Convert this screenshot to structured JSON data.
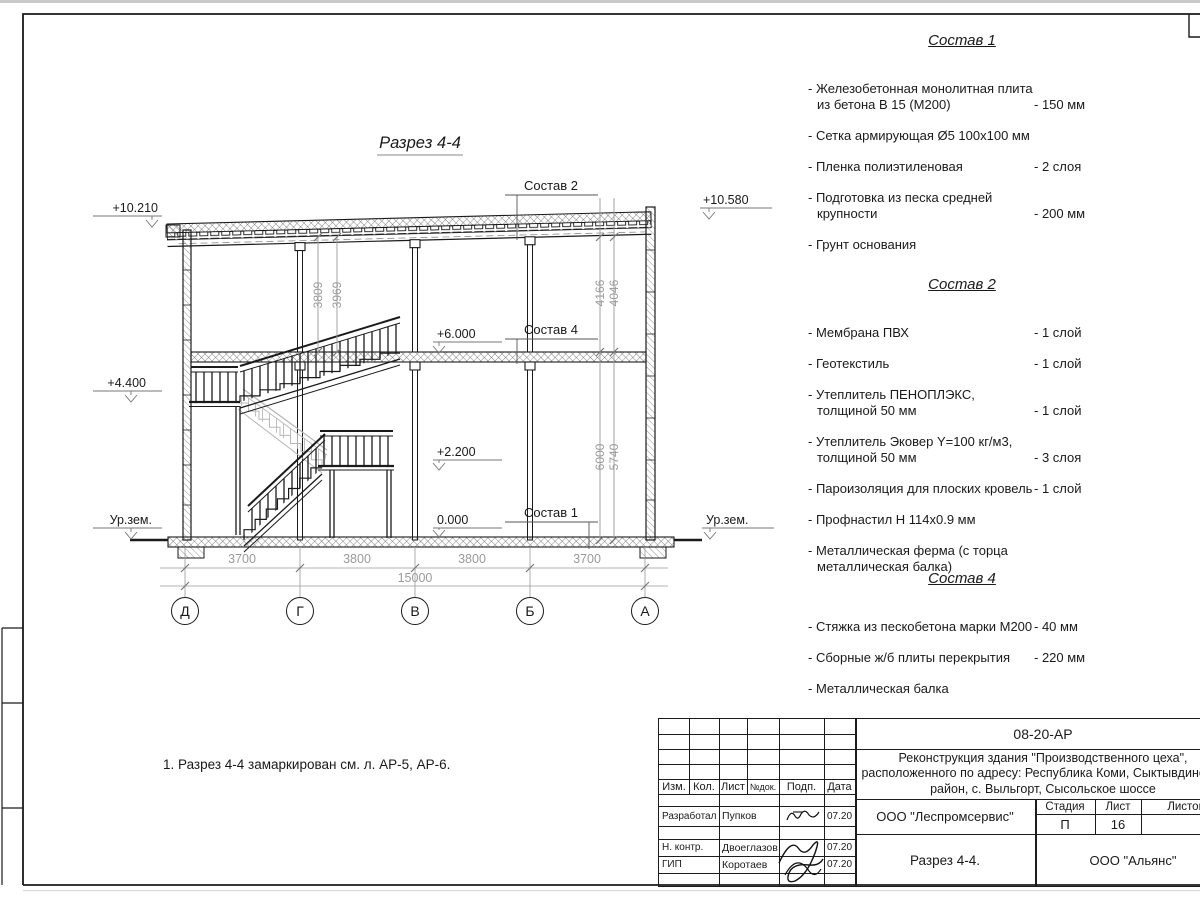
{
  "page": {
    "bg": "#ffffff",
    "line_color": "#1a1a1a",
    "dim_color": "#9a9a9a"
  },
  "drawing": {
    "title": "Разрез 4-4",
    "levels": {
      "roof_left": "+10.210",
      "roof_right": "+10.580",
      "floor2": "+6.000",
      "landing_upper": "+4.400",
      "landing_lower": "+2.200",
      "floor1": "0.000",
      "ground_left": "Ур.зем.",
      "ground_right": "Ур.зем."
    },
    "callouts": {
      "c2": "Состав 2",
      "c4": "Состав 4",
      "c1": "Состав 1"
    },
    "vdims": [
      "3809",
      "3969",
      "4166",
      "4046",
      "6000",
      "5740"
    ],
    "hdims": [
      "3700",
      "3800",
      "3800",
      "3700"
    ],
    "total": "15000",
    "axes": [
      "Д",
      "Г",
      "В",
      "Б",
      "А"
    ],
    "note": "1. Разрез 4-4 замаркирован см. л. АР-5, АР-6."
  },
  "compositions": [
    {
      "title": "Состав 1",
      "items": [
        {
          "name": "- Железобетонная  монолитная плита из бетона В 15 (М200)",
          "value": "- 150 мм"
        },
        {
          "name": "- Сетка армирующая Ø5 100х100 мм",
          "value": ""
        },
        {
          "name": "- Пленка полиэтиленовая",
          "value": "-  2 слоя"
        },
        {
          "name": "- Подготовка из песка средней крупности",
          "value": "- 200 мм"
        },
        {
          "name": "- Грунт основания",
          "value": ""
        }
      ]
    },
    {
      "title": "Состав 2",
      "items": [
        {
          "name": "- Мембрана ПВХ",
          "value": "- 1 слой"
        },
        {
          "name": "- Геотекстиль",
          "value": "- 1 слой"
        },
        {
          "name": "- Утеплитель ПЕНОПЛЭКС, толщиной 50 мм",
          "value": "- 1 слой"
        },
        {
          "name": "- Утеплитель Эковер Y=100 кг/м3, толщиной 50 мм",
          "value": "- 3 слоя"
        },
        {
          "name": "- Пароизоляция для плоских кровель",
          "value": "- 1 слой"
        },
        {
          "name": "- Профнастил Н 114х0.9 мм",
          "value": ""
        },
        {
          "name": "- Металлическая ферма (с торца металлическая балка)",
          "value": ""
        }
      ]
    },
    {
      "title": "Состав 4",
      "items": [
        {
          "name": "- Стяжка из пескобетона марки М200",
          "value": "- 40 мм"
        },
        {
          "name": "- Сборные ж/б плиты перекрытия",
          "value": "- 220 мм"
        },
        {
          "name": "- Металлическая балка",
          "value": ""
        }
      ]
    }
  ],
  "title_block": {
    "doc_code": "08-20-АР",
    "project_lines": [
      "Реконструкция здания \"Производственного цеха\",",
      "расположенного по адресу: Республика Коми, Сыктывдинский",
      "район, с. Выльгорт, Сысольское шоссе"
    ],
    "cols": {
      "izm": "Изм.",
      "kol": "Кол.",
      "list": "Лист",
      "ndok": "№док.",
      "podp": "Подп.",
      "data": "Дата"
    },
    "rows": [
      {
        "role": "Разработал",
        "name": "Пупков",
        "date": "07.20"
      },
      {
        "role": "Н. контр.",
        "name": "Двоеглазов",
        "date": "07.20"
      },
      {
        "role": "ГИП",
        "name": "Коротаев",
        "date": "07.20"
      }
    ],
    "org1": "ООО \"Леспромсервис\"",
    "stage_label": "Стадия",
    "sheet_label": "Лист",
    "sheets_label": "Листов",
    "stage": "П",
    "sheet_no": "16",
    "drawing_name": "Разрез 4-4.",
    "org2": "ООО \"Альянс\""
  }
}
